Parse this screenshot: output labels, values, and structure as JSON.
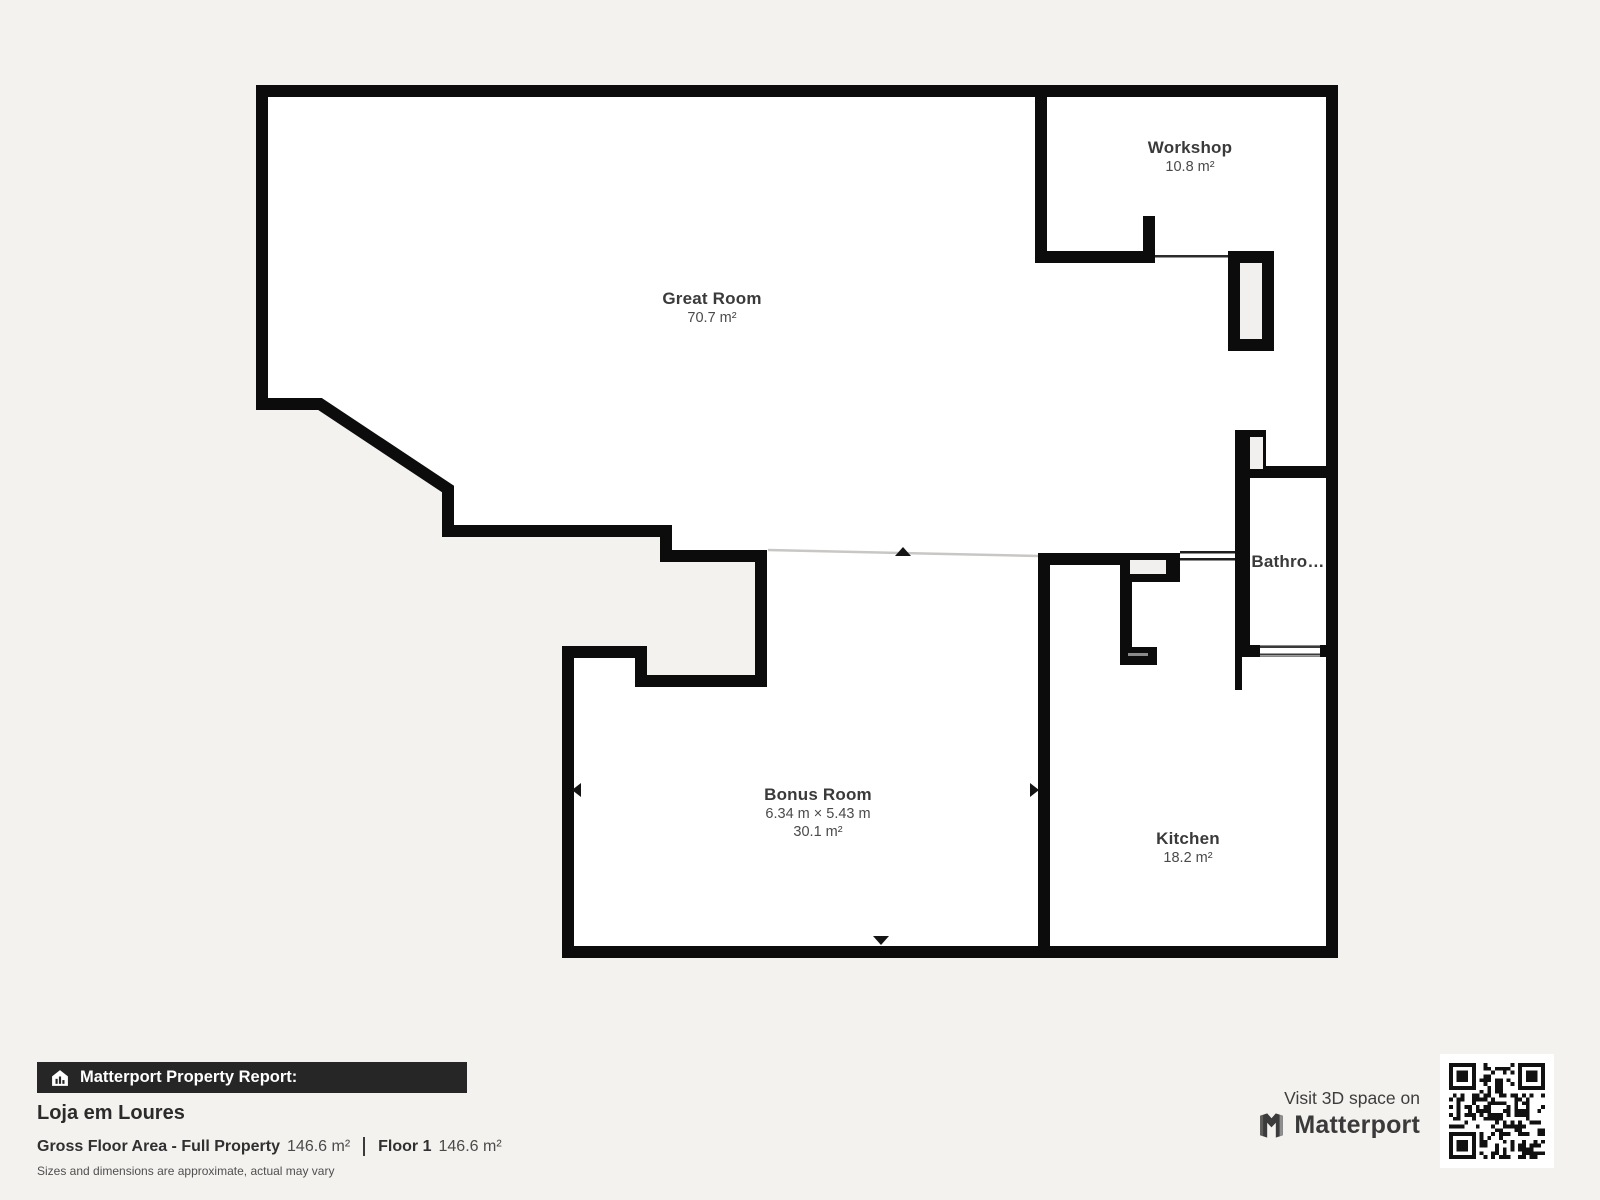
{
  "colors": {
    "background": "#f4f2ef",
    "wall": "#0c0c0c",
    "floor": "#ffffff",
    "shaft_fill": "#f2f0ee",
    "badge_bar": "#262626",
    "label_text": "#3a3a3a"
  },
  "floorplan": {
    "rooms": [
      {
        "name": "Great Room",
        "area": "70.7 m²"
      },
      {
        "name": "Workshop",
        "area": "10.8 m²"
      },
      {
        "name": "Bathro…"
      },
      {
        "name": "Bonus Room",
        "dimensions": "6.34 m × 5.43 m",
        "area": "30.1 m²"
      },
      {
        "name": "Kitchen",
        "area": "18.2 m²"
      }
    ]
  },
  "report": {
    "badge_icon": "house-chart-icon",
    "badge_label": "Matterport Property Report:",
    "property_name": "Loja em Loures",
    "gross_area_label": "Gross Floor Area - Full Property",
    "gross_area_value": "146.6 m²",
    "floor_label": "Floor 1",
    "floor_value": "146.6 m²",
    "disclaimer": "Sizes and dimensions are approximate, actual may vary"
  },
  "cta": {
    "visit_text": "Visit 3D space on",
    "brand_icon": "matterport-logo-icon",
    "brand_name": "Matterport",
    "qr_icon": "qr-code"
  }
}
